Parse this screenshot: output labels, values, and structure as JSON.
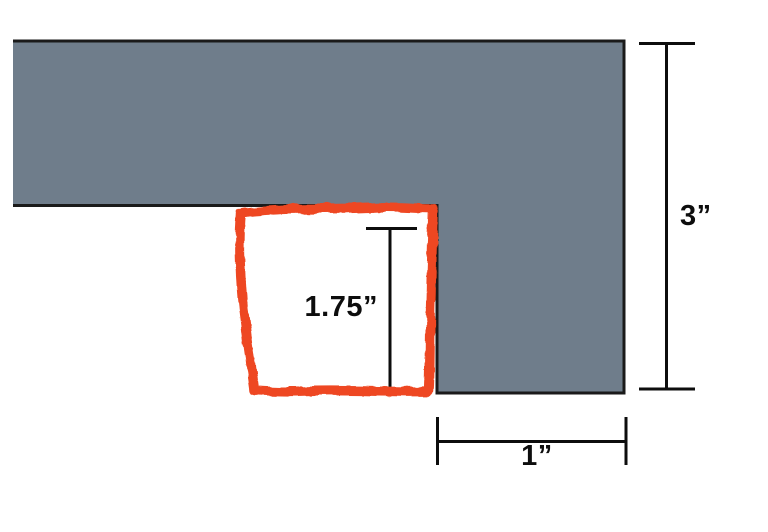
{
  "diagram": {
    "labels": {
      "height": "3”",
      "notch_depth": "1.75”",
      "leg_width": "1”"
    },
    "colors": {
      "part_fill": "#6f7d8b",
      "part_outline": "#1a1a1a",
      "dimension_lines": "#0d0d0d",
      "highlight": "#ee4722",
      "background": "#ffffff"
    }
  }
}
